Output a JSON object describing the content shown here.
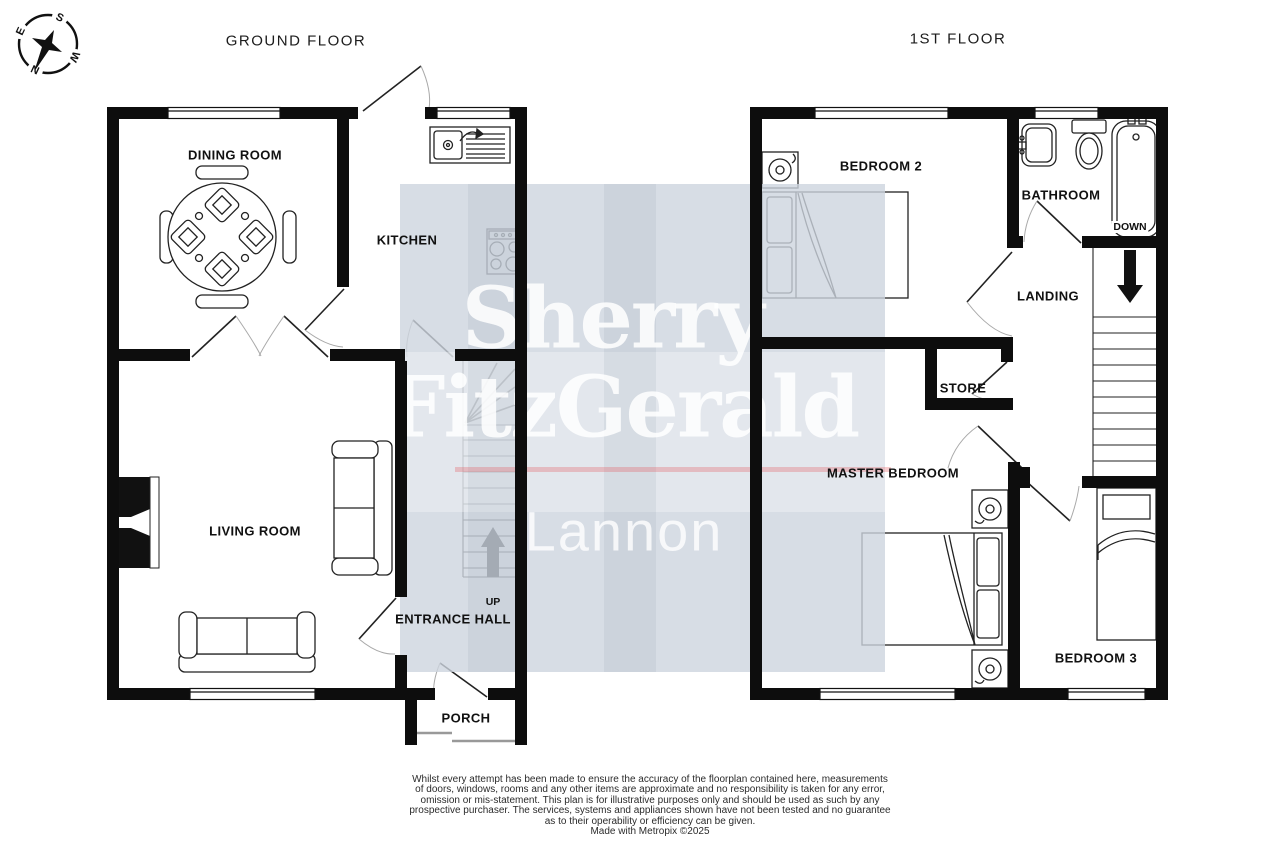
{
  "ground_floor": {
    "title": "GROUND FLOOR",
    "rooms": {
      "dining_room": "DINING ROOM",
      "kitchen": "KITCHEN",
      "living_room": "LIVING ROOM",
      "entrance_hall": "ENTRANCE HALL",
      "porch": "PORCH"
    },
    "stairs_direction": "UP"
  },
  "first_floor": {
    "title": "1ST FLOOR",
    "rooms": {
      "bedroom2": "BEDROOM 2",
      "bathroom": "BATHROOM",
      "landing": "LANDING",
      "store": "STORE",
      "master_bedroom": "MASTER BEDROOM",
      "bedroom3": "BEDROOM 3"
    },
    "stairs_direction": "DOWN"
  },
  "watermark": {
    "brand_line1": "Sherry",
    "brand_line2": "FitzGerald",
    "brand_line3": "Lannon",
    "overlay_color": "#cdd5de",
    "accent_line_color": "#e4555e"
  },
  "compass": {
    "north": "N",
    "south": "S",
    "east": "E",
    "west": "W"
  },
  "disclaimer": {
    "lines": [
      "Whilst every attempt has been made to ensure the accuracy of the floorplan contained here, measurements",
      "of doors, windows, rooms and any other items are approximate and no responsibility is taken for any error,",
      "omission or mis-statement. This plan is for illustrative purposes only and should be used as such by any",
      "prospective purchaser. The services, systems and appliances shown have not been tested and no guarantee",
      "as to their operability or efficiency can be given."
    ],
    "credit": "Made with Metropix ©2025"
  }
}
